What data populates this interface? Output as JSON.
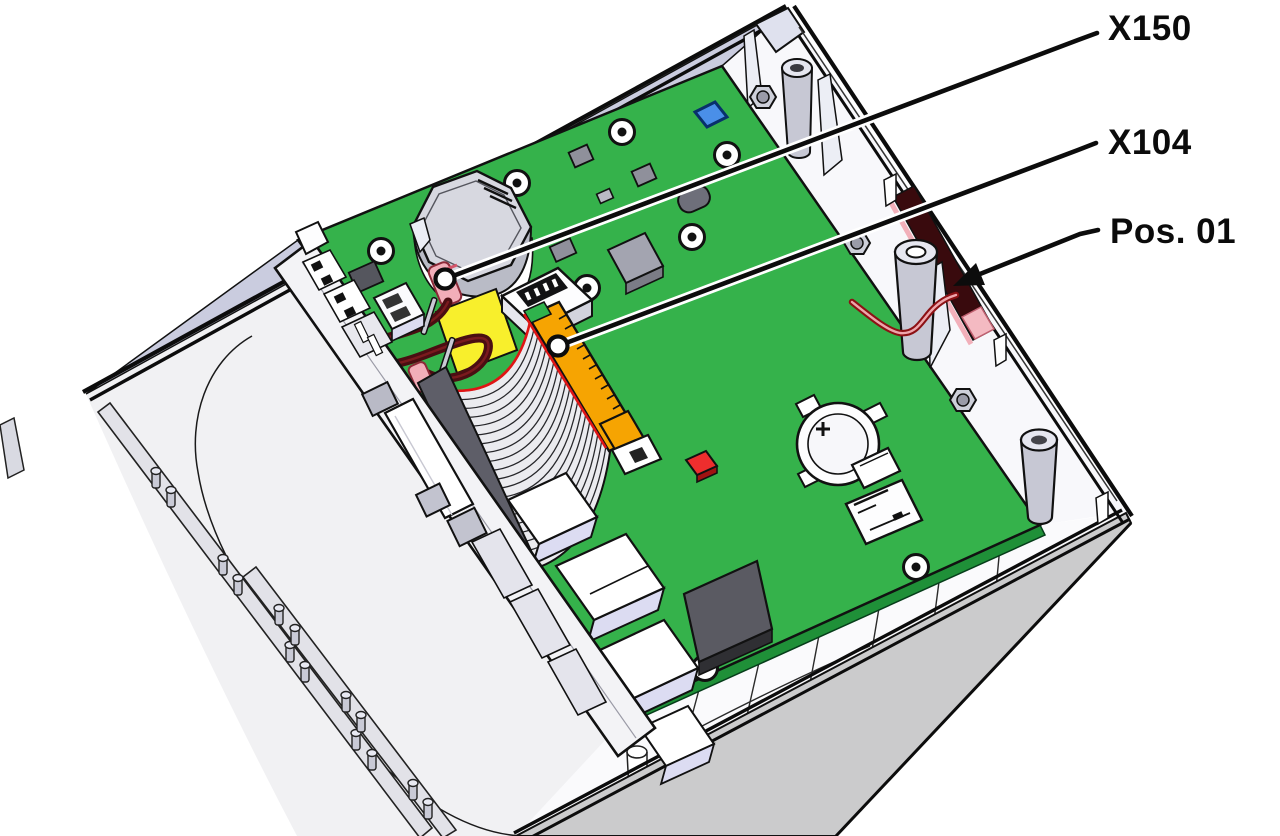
{
  "callouts": [
    {
      "id": "x150",
      "label": "X150",
      "target": "antenna-pigtail-connector"
    },
    {
      "id": "x104",
      "label": "X104",
      "target": "ribbon-cable-connector"
    },
    {
      "id": "pos01",
      "label": "Pos. 01",
      "target": "antenna-wire-routing-position"
    }
  ],
  "battery_marking": "+",
  "colors": {
    "background": "#ffffff",
    "callout_black": "#0b0b0b",
    "pcb_green": "#35b24b",
    "pcb_edge_green": "#1f9038",
    "case_white": "#f8f8fb",
    "case_inner_lavender": "#caccdf",
    "case_tray_gray": "#f1f1f3",
    "case_wall_gray": "#cbcbcc",
    "component_gray_light": "#a3a4b0",
    "component_gray_dark": "#5a5a62",
    "ribbon_gray": "#ebebef",
    "connector_orange": "#f6a402",
    "foam_yellow": "#f8ef2c",
    "wire_dark_red": "#4a0e12",
    "antenna_maroon": "#390a0d",
    "antenna_pink": "#f2b0ba",
    "connector_pink": "#f2aeb9",
    "led_red": "#ee2e2e",
    "chip_blue": "#4a8fe8"
  }
}
